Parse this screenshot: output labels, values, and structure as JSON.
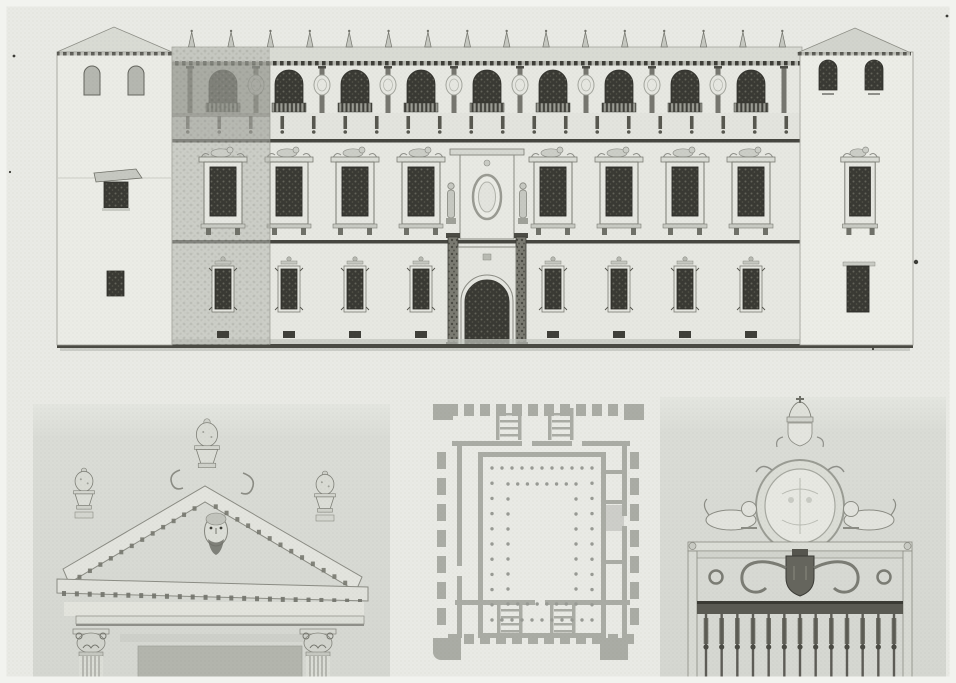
{
  "plate": {
    "type": "scanned-architectural-plate",
    "subject": "renaissance-palace-elevation-plan-and-details",
    "colors": {
      "paper": "#e9eae5",
      "paper_edge": "#f2f3ef",
      "wash": "#d8dad4",
      "wall": "#e7e8e2",
      "roof": "#d9dbd4",
      "line": "#45453f",
      "line_soft": "#9b9c94",
      "glass_dark": "#393933",
      "shade": "#b6b8b1",
      "plan_wall": "#a2a49d",
      "rail_dark": "#4f4f48"
    },
    "specks": [
      [
        916,
        262,
        2.2
      ],
      [
        947,
        16,
        1.4
      ],
      [
        14,
        56,
        1.4
      ],
      [
        10,
        172,
        1.1
      ],
      [
        873,
        349,
        1.1
      ]
    ]
  },
  "facade": {
    "label": "palace-facade-elevation",
    "roof_finials": 16,
    "gallery": {
      "arched_windows": 9,
      "shield_reliefs": 8,
      "pilasters": 10,
      "corbels": 20
    },
    "middle_floor": {
      "windows_left": 4,
      "windows_right": 4,
      "aedicule_statues": 2,
      "oval_medallions": 1
    },
    "ground_floor": {
      "windows_left": 4,
      "windows_right": 4,
      "portal_arches": 1,
      "portal_columns": 2
    },
    "towers": {
      "left_arched_windows": 2,
      "right_arched_windows": 2
    }
  },
  "pediment_detail": {
    "label": "window-pediment-with-mask-detail",
    "urn_finials": 3,
    "mask_heads": 1,
    "corinthian_capitals": 2,
    "raking_dentils_left": 12,
    "raking_dentils_right": 13,
    "horizontal_dentils": 24,
    "column_flutes": 5
  },
  "floor_plan": {
    "label": "ground-plan-with-arcaded-courtyard",
    "corner_towers": 4,
    "stairs_top": 2,
    "stairs_bottom": 2,
    "outer_piers_top": 12,
    "outer_piers_bottom": 12,
    "outer_piers_side": 7,
    "colonnade_outer": {
      "dots_top": 11,
      "dots_side": 9
    },
    "colonnade_inner": {
      "dots_top": 8,
      "dots_side": 7
    }
  },
  "gate_detail": {
    "label": "gate-crest-and-iron-grille-detail",
    "crowns": 1,
    "cartouche_ovals": 1,
    "lions": 2,
    "scroll_rings": 2,
    "grille_bars": 13,
    "end_posts": 2
  }
}
